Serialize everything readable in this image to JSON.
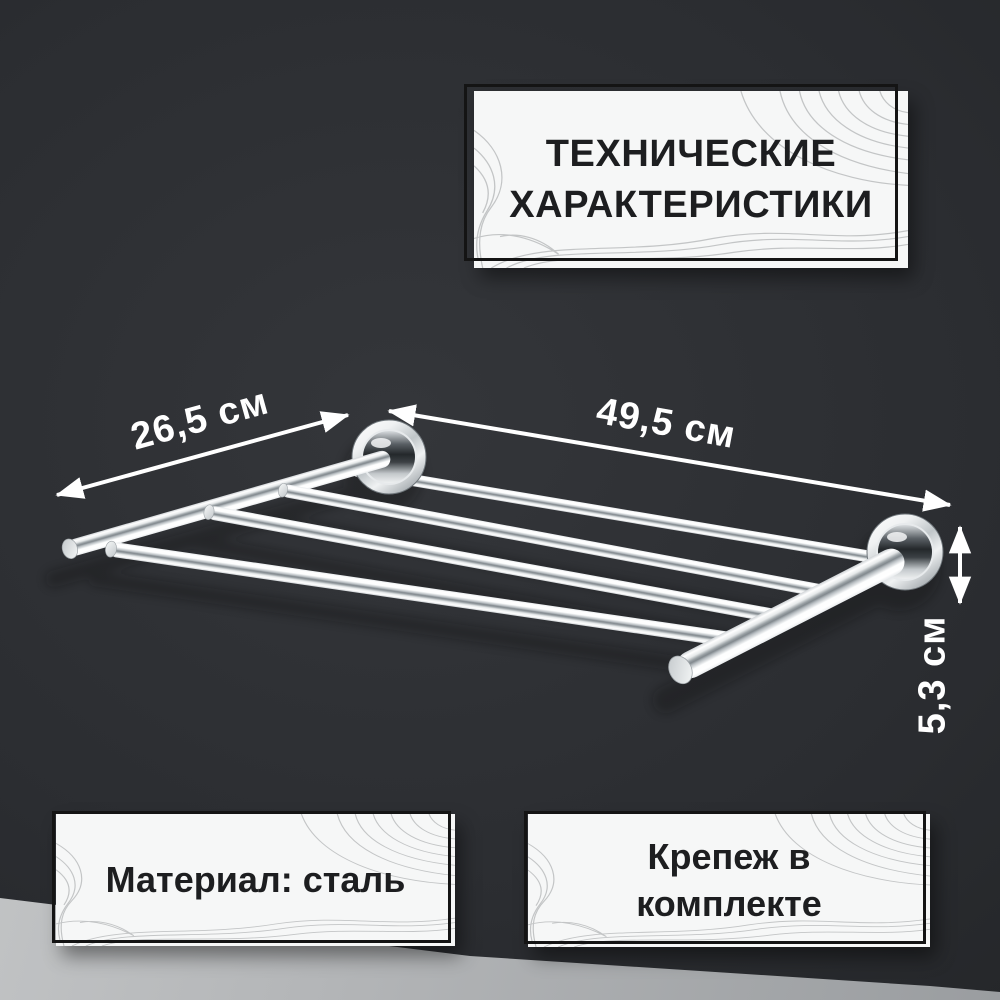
{
  "scene": {
    "description": "product infographic of a chrome wall-mounted towel rack shelf",
    "palette": {
      "wall": "#2b2d31",
      "floor": "#b4b6b8",
      "box_background": "#f6f7f7",
      "box_frame": "#141414",
      "box_text": "#1d1e20",
      "dimension_text": "#ffffff",
      "chrome": "#dfe3e6"
    }
  },
  "title_box": {
    "line1": "ТЕХНИЧЕСКИЕ",
    "line2": "ХАРАКТЕРИСТИКИ"
  },
  "dimensions": {
    "depth_label": "26,5 см",
    "width_label": "49,5 см",
    "height_label": "5,3 см"
  },
  "material_box": {
    "text": "Материал: сталь"
  },
  "hardware_box": {
    "line1": "Крепеж в",
    "line2": "комплекте"
  }
}
